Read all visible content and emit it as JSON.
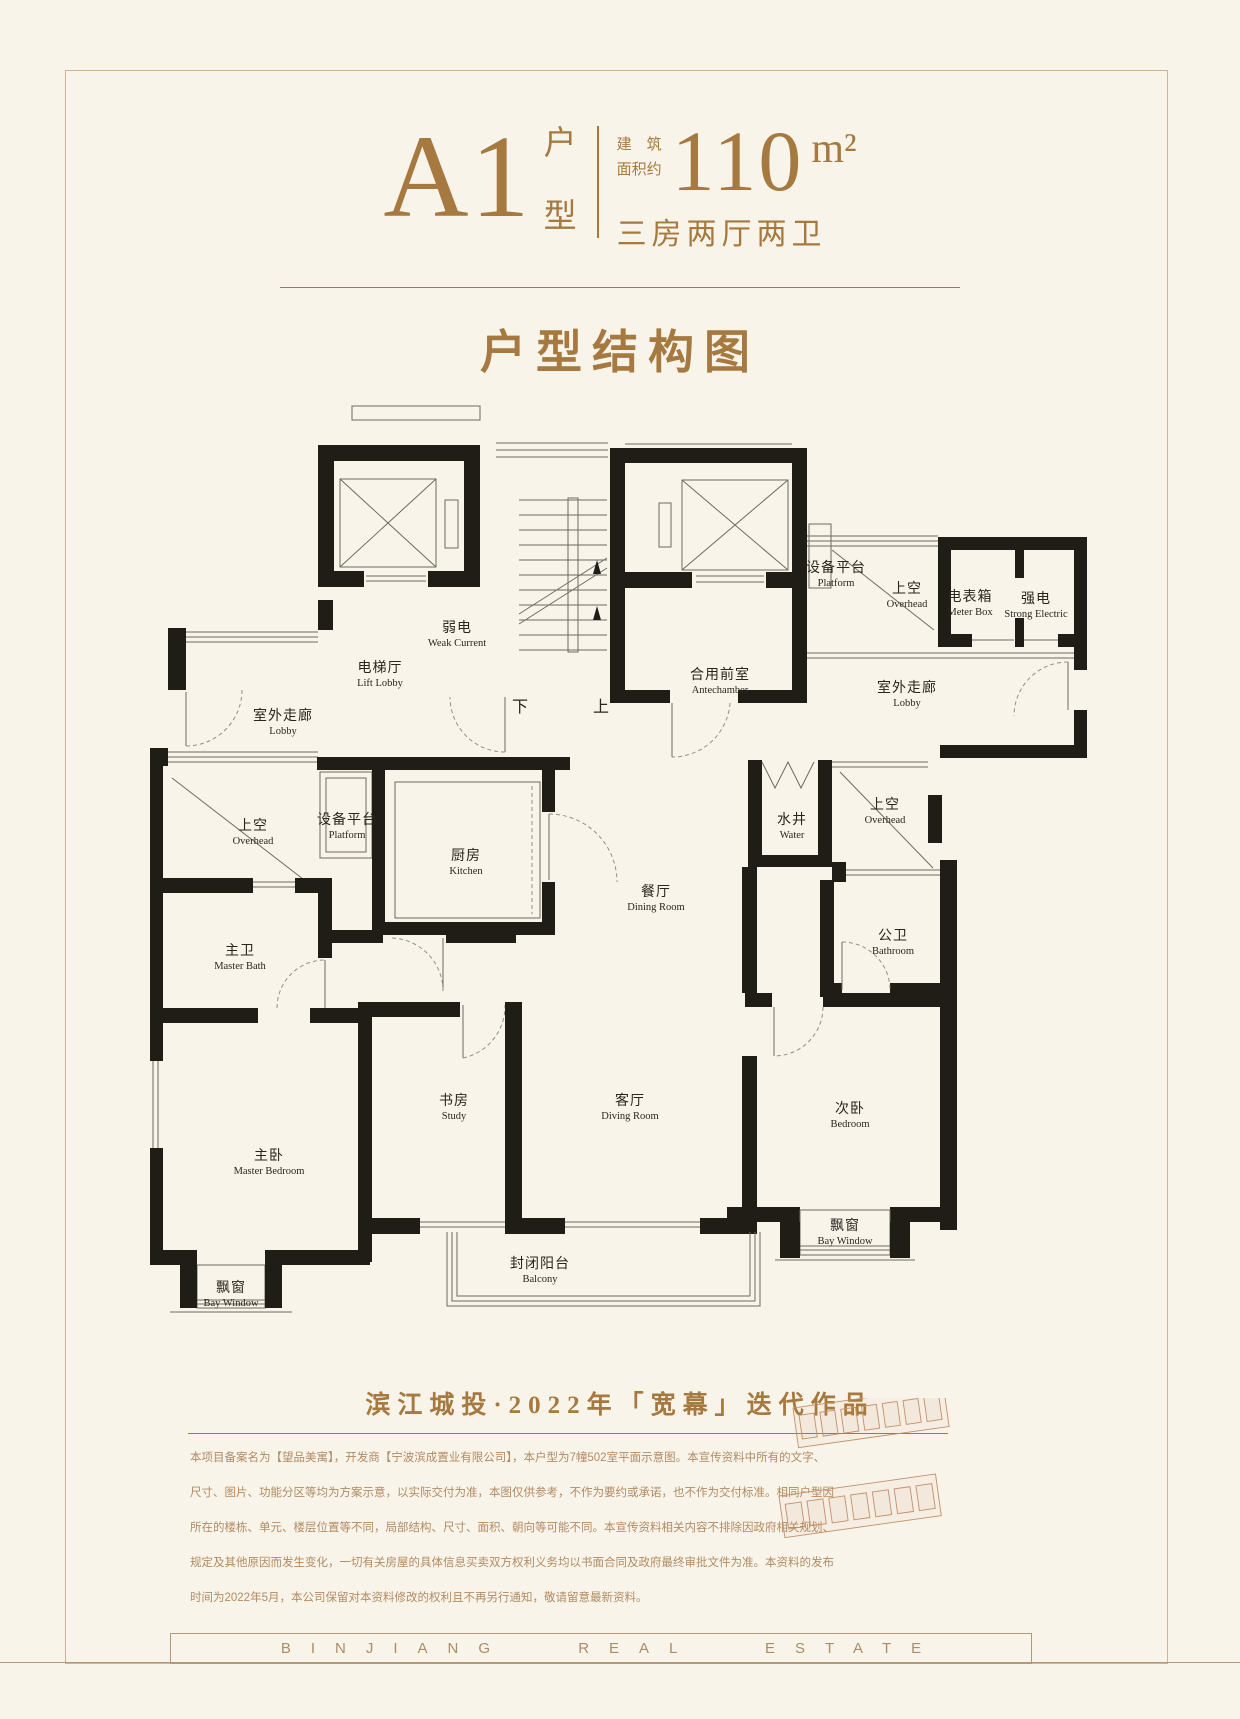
{
  "colors": {
    "accent": "#a5793f",
    "rule": "#b59877",
    "wall": "#201d17",
    "plan_text": "#2a261e",
    "disclaimer_text": "#b18b63",
    "sketch": "#c28f6b",
    "background": "#f9f4ea"
  },
  "header": {
    "unit": "A1",
    "unit_suffix_top": "户",
    "unit_suffix_bottom": "型",
    "area_prefix_line1": "建　筑",
    "area_prefix_line2": "面积约",
    "area_value": "110",
    "area_unit": "m²",
    "spec": "三房两厅两卫"
  },
  "section_title": "户型结构图",
  "floor_plan": {
    "stair_down": "下",
    "stair_up": "上",
    "labels": [
      {
        "cn": "弱电",
        "en": "Weak Current",
        "x": 457,
        "y": 632
      },
      {
        "cn": "电梯厅",
        "en": "Lift Lobby",
        "x": 380,
        "y": 672
      },
      {
        "cn": "室外走廊",
        "en": "Lobby",
        "x": 283,
        "y": 720
      },
      {
        "cn": "合用前室",
        "en": "Antechamber",
        "x": 720,
        "y": 679
      },
      {
        "cn": "设备平台",
        "en": "Platform",
        "x": 836,
        "y": 572
      },
      {
        "cn": "上空",
        "en": "Overhead",
        "x": 907,
        "y": 593
      },
      {
        "cn": "电表箱",
        "en": "Meter Box",
        "x": 970,
        "y": 601
      },
      {
        "cn": "强电",
        "en": "Strong Electric",
        "x": 1036,
        "y": 603
      },
      {
        "cn": "室外走廊",
        "en": "Lobby",
        "x": 907,
        "y": 692
      },
      {
        "cn": "上空",
        "en": "Overhead",
        "x": 253,
        "y": 830
      },
      {
        "cn": "设备平台",
        "en": "Platform",
        "x": 347,
        "y": 824
      },
      {
        "cn": "厨房",
        "en": "Kitchen",
        "x": 466,
        "y": 860
      },
      {
        "cn": "水井",
        "en": "Water",
        "x": 792,
        "y": 824
      },
      {
        "cn": "上空",
        "en": "Overhead",
        "x": 885,
        "y": 809
      },
      {
        "cn": "餐厅",
        "en": "Dining Room",
        "x": 656,
        "y": 896
      },
      {
        "cn": "主卫",
        "en": "Master Bath",
        "x": 240,
        "y": 955
      },
      {
        "cn": "公卫",
        "en": "Bathroom",
        "x": 893,
        "y": 940
      },
      {
        "cn": "书房",
        "en": "Study",
        "x": 454,
        "y": 1105
      },
      {
        "cn": "客厅",
        "en": "Diving Room",
        "x": 630,
        "y": 1105
      },
      {
        "cn": "次卧",
        "en": "Bedroom",
        "x": 850,
        "y": 1113
      },
      {
        "cn": "主卧",
        "en": "Master Bedroom",
        "x": 269,
        "y": 1160
      },
      {
        "cn": "飘窗",
        "en": "Bay Window",
        "x": 231,
        "y": 1292
      },
      {
        "cn": "封闭阳台",
        "en": "Balcony",
        "x": 540,
        "y": 1268
      },
      {
        "cn": "飘窗",
        "en": "Bay Window",
        "x": 845,
        "y": 1230
      }
    ]
  },
  "tagline": "滨江城投·2022年「宽幕」迭代作品",
  "disclaimer": {
    "lines": [
      "本项目备案名为【望品美寓】，开发商【宁波滨成置业有限公司】，本户型为7幢502室平面示意图。本宣传资料中所有的文字、",
      "尺寸、图片、功能分区等均为方案示意，以实际交付为准，本图仅供参考，不作为要约或承诺，也不作为交付标准。相同户型因",
      "所在的楼栋、单元、楼层位置等不同，局部结构、尺寸、面积、朝向等可能不同。本宣传资料相关内容不排除因政府相关规划、",
      "规定及其他原因而发生变化，一切有关房屋的具体信息买卖双方权利义务均以书面合同及政府最终审批文件为准。本资料的发布",
      "时间为2022年5月，本公司保留对本资料修改的权利且不再另行通知，敬请留意最新资料。"
    ]
  },
  "footer_band": "BINJIANG REAL ESTATE"
}
